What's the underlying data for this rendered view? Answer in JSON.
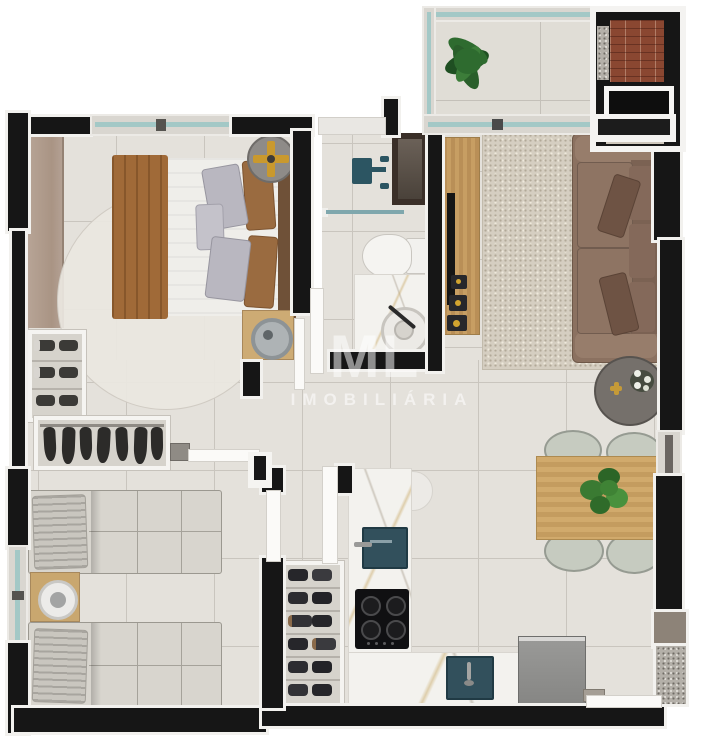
{
  "image": {
    "kind": "apartment-floor-plan-render",
    "view": "top-down 3D render",
    "background": "#ffffff"
  },
  "watermark": {
    "monogram": "ML",
    "label": "IMOBILIÁRIA"
  },
  "palette": {
    "wall": "#161616",
    "wall_trim": "#f2f1ee",
    "floor_tile": "#e4e1db",
    "grout": "#c9c5be",
    "window_glass": "#a3c8c6",
    "sink_teal": "#32505c",
    "wood": "#c79e63",
    "sofa_brown": "#8b7160",
    "bed_blanket_brown": "#a06a38",
    "brick": "#8a4731",
    "plant_green": "#3a7a32",
    "rug_living": "#d5cec1",
    "marble": "#f3f2ee"
  },
  "rooms": [
    {
      "name": "bedroom-1",
      "items": [
        "double-bed",
        "brown-blanket",
        "pillows",
        "round-rug",
        "wardrobe-panel",
        "ceiling-fan",
        "nightstand-with-lamp",
        "window"
      ]
    },
    {
      "name": "bathroom",
      "items": [
        "shower",
        "glass-partition",
        "niche",
        "toilet",
        "vanity-round-sink",
        "door"
      ]
    },
    {
      "name": "balcony",
      "items": [
        "plant",
        "glass-railing",
        "sliding-door"
      ]
    },
    {
      "name": "barbecue-area",
      "items": [
        "brick-wall",
        "granite-pillar",
        "grill",
        "counter"
      ]
    },
    {
      "name": "living-room",
      "items": [
        "tv-console",
        "tv",
        "decor-objects",
        "area-rug",
        "sofa",
        "side-table-with-flowers"
      ]
    },
    {
      "name": "dining-area",
      "items": [
        "wood-table",
        "plant-centerpiece",
        "chair",
        "chair",
        "chair",
        "chair"
      ]
    },
    {
      "name": "kitchen",
      "items": [
        "l-shaped-marble-counter",
        "sink",
        "cooktop-4-burners",
        "second-sink",
        "pantry-shelf",
        "refrigerator",
        "service-door"
      ]
    },
    {
      "name": "closet-hall",
      "items": [
        "shoe-rack",
        "hanging-clothes-rack",
        "doors"
      ]
    },
    {
      "name": "bedroom-2",
      "items": [
        "single-bed",
        "single-bed",
        "nightstand-with-lamp",
        "side-window"
      ]
    }
  ]
}
